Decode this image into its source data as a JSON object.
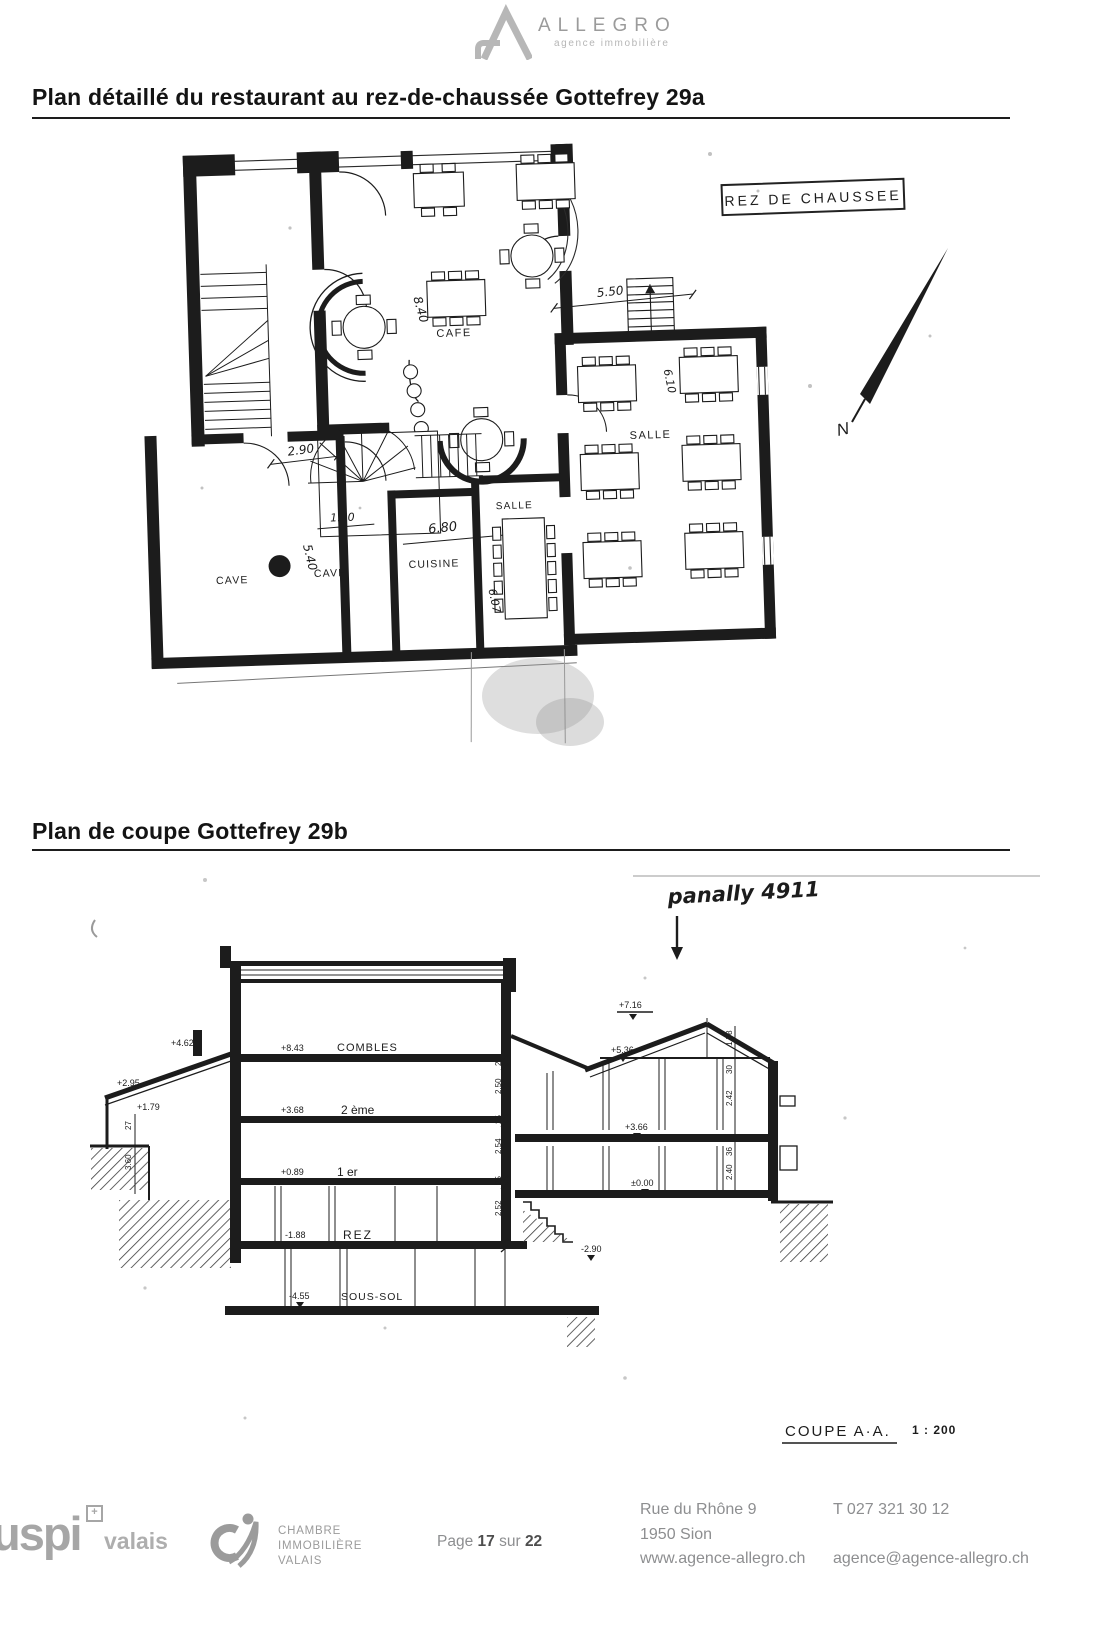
{
  "header": {
    "brand": "ALLEGRO",
    "tagline": "agence immobilière"
  },
  "titles": {
    "plan": "Plan détaillé du restaurant au rez-de-chaussée Gottefrey 29a",
    "coupe": "Plan de coupe Gottefrey 29b"
  },
  "floor_plan": {
    "title_box": "REZ DE CHAUSSEE",
    "north": "N",
    "rooms": {
      "cafe": "CAFE",
      "salle_right": "SALLE",
      "salle_mid": "SALLE",
      "cave_left": "CAVE",
      "cave_mid": "CAVE",
      "cuisine": "CUISINE"
    },
    "dims": {
      "d550": "5.50",
      "d840": "8.40",
      "d290": "2.90",
      "d150": "1.50",
      "d540": "5.40",
      "d680": "6.80",
      "d610": "6.10",
      "d607": "6.07"
    }
  },
  "section_plan": {
    "note": "panally 4911",
    "levels": {
      "combles": {
        "elev": "+8.43",
        "name": "COMBLES"
      },
      "deuxieme": {
        "elev": "+3.68",
        "name": "2 ème"
      },
      "premier": {
        "elev": "+0.89",
        "name": "1 er"
      },
      "rez": {
        "elev": "-1.88",
        "name": "REZ"
      },
      "sous_sol": {
        "elev": "-4.55",
        "name": "SOUS-SOL"
      }
    },
    "right": {
      "ridge": "+7.16",
      "attic": "+5.36",
      "floor": "+3.66",
      "ground": "±0.00",
      "stair": "-2.90"
    },
    "left": {
      "e1": "+4.62",
      "e2": "+2.95",
      "e3": "+1.79"
    },
    "dims_left": [
      "25",
      "2.50",
      "25",
      "2.54",
      "25",
      "2.52"
    ],
    "dims_right": [
      "1.78",
      "30",
      "2.42",
      "36",
      "2.40"
    ],
    "dims_far_left": [
      "27",
      "3.60"
    ],
    "caption": "COUPE A·A.",
    "scale": "1 : 200"
  },
  "footer": {
    "uspi_name": "uspi",
    "uspi_cross": "+",
    "uspi_region": "valais",
    "chambre_lines": [
      "CHAMBRE",
      "IMMOBILIÈRE",
      "VALAIS"
    ],
    "page_prefix": "Page",
    "page_number": "17",
    "page_sep": "sur",
    "page_total": "22",
    "address1": "Rue du Rhône 9",
    "address2": "1950 Sion",
    "website": "www.agence-allegro.ch",
    "phone": "T 027 321 30 12",
    "email": "agence@agence-allegro.ch"
  }
}
